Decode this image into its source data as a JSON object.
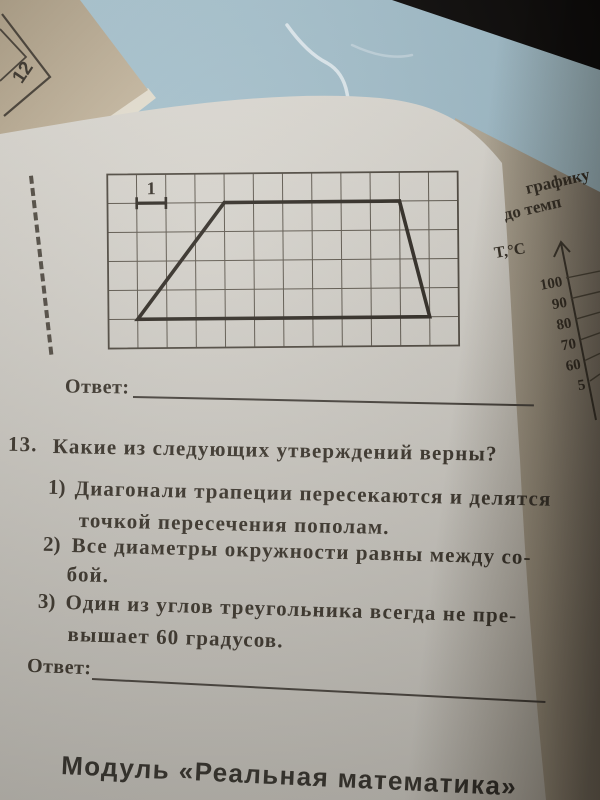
{
  "scene": {
    "table_color": "#a1bdc9",
    "corner_shadow_color": "#0b0908",
    "main_page_color": "#cdcac3",
    "right_page_color": "#a79d8b",
    "booklet_color": "#b7a98f"
  },
  "neighbor_booklet": {
    "page_number": "12"
  },
  "main_page": {
    "figure": {
      "grid_cols": 12,
      "grid_rows": 6,
      "trapezoid_cells": [
        [
          1,
          5
        ],
        [
          4,
          1
        ],
        [
          10,
          1
        ],
        [
          11,
          5
        ]
      ],
      "unit_marker": {
        "from": [
          1,
          1
        ],
        "to": [
          2,
          1
        ]
      },
      "unit_label": "1"
    },
    "answer_top": {
      "label": "Ответ:"
    },
    "task13": {
      "number": "13.",
      "question": "Какие из следующих утверждений верны?",
      "items": [
        {
          "marker": "1)",
          "line1": "Диагонали трапеции пересекаются и делятся",
          "line2": "точкой пересечения пополам."
        },
        {
          "marker": "2)",
          "line1": "Все диаметры окружности равны между со-",
          "line2": "бой."
        },
        {
          "marker": "3)",
          "line1": "Один из углов треугольника всегда не пре-",
          "line2": "вышает 60 градусов."
        }
      ]
    },
    "answer_bottom": {
      "label": "Ответ:"
    },
    "footer": "Модуль «Реальная математика»"
  },
  "right_page": {
    "heading_fragment_1": "графику",
    "heading_fragment_2": "до темп",
    "axis_title": "T,°C",
    "axis_ticks": [
      "100",
      "90",
      "80",
      "70",
      "60",
      "5"
    ]
  }
}
